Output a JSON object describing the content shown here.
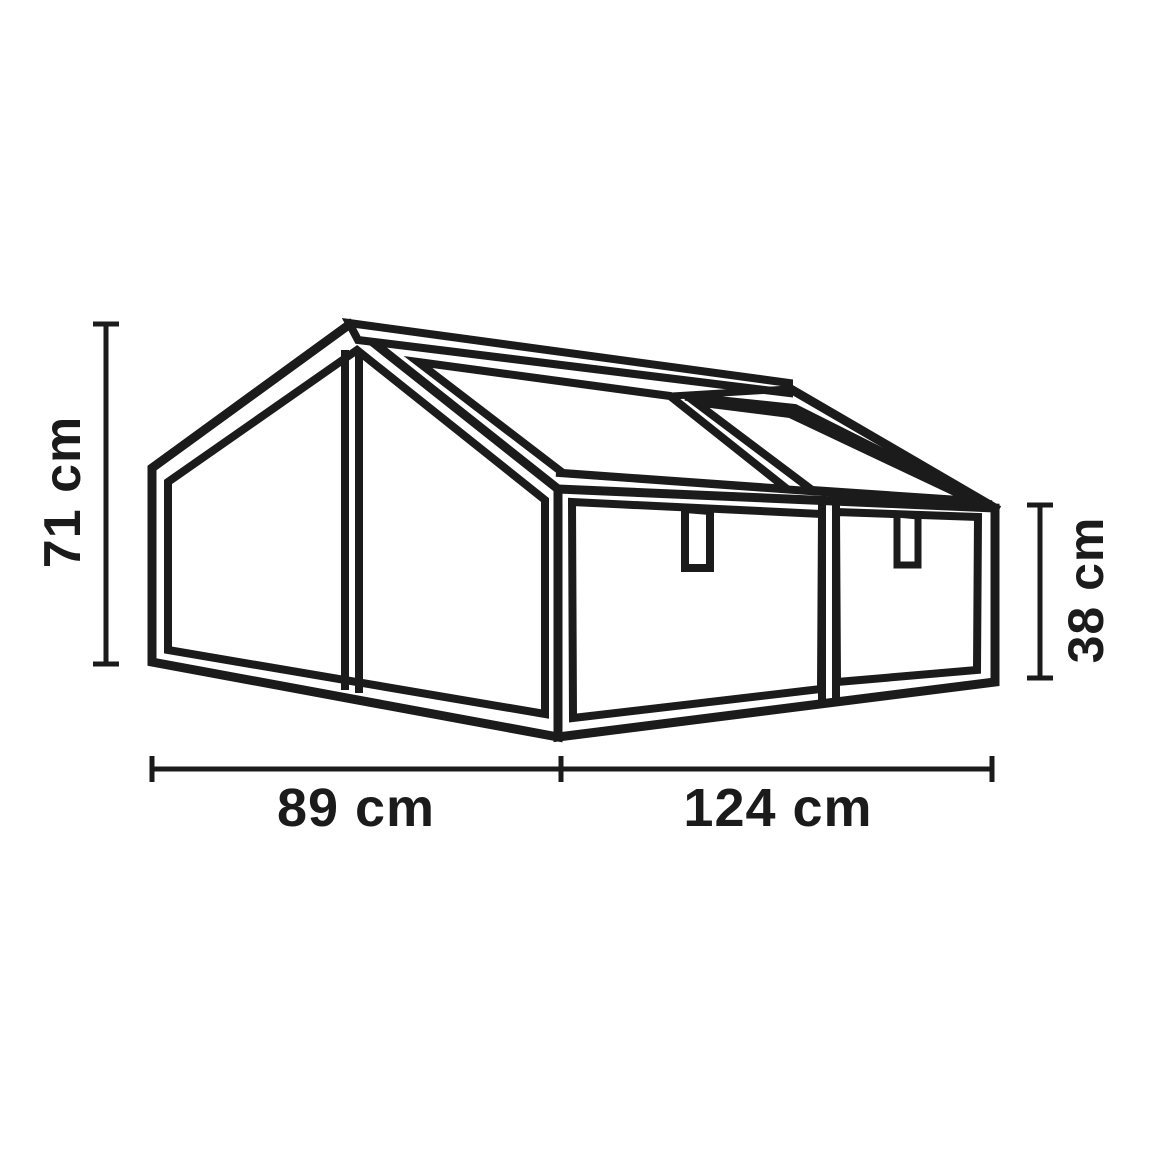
{
  "page": {
    "background": "#ffffff",
    "line_color": "#1b1b1b",
    "subject": "double cold frame greenhouse dimension drawing"
  },
  "dimensions": {
    "total_height": {
      "label": "71 cm",
      "orientation": "vertical-left"
    },
    "front_height": {
      "label": "38 cm",
      "orientation": "vertical-right"
    },
    "side_depth": {
      "label": "89 cm",
      "orientation": "horizontal-bottom-left"
    },
    "front_width": {
      "label": "124 cm",
      "orientation": "horizontal-bottom-right"
    }
  }
}
